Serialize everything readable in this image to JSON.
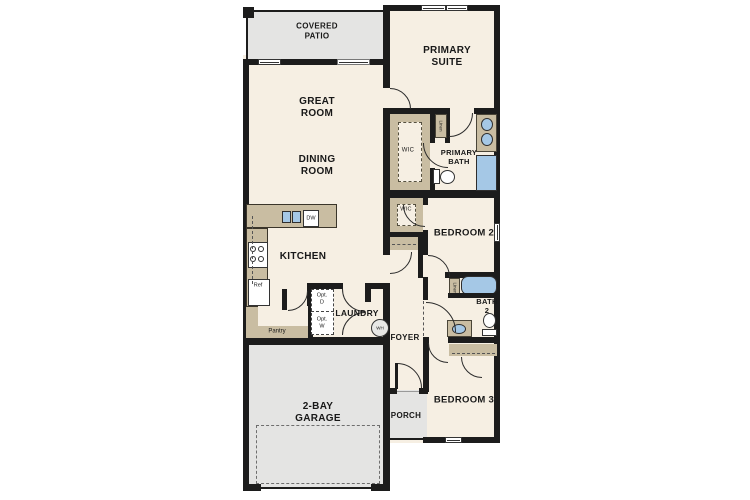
{
  "rooms": {
    "covered_patio": "COVERED\nPATIO",
    "primary_suite": "PRIMARY\nSUITE",
    "great_room": "GREAT\nROOM",
    "dining_room": "DINING\nROOM",
    "kitchen": "KITCHEN",
    "wic_primary": "WIC",
    "primary_bath": "PRIMARY\nBATH",
    "bedroom_2": "BEDROOM 2",
    "wic_bedroom2": "WIC",
    "bath_2": "BATH\n2",
    "laundry": "LAUNDRY",
    "foyer": "FOYER",
    "porch": "PORCH",
    "bedroom_3": "BEDROOM 3",
    "garage": "2-BAY\nGARAGE"
  },
  "fixtures": {
    "linen_primary": "Linen",
    "linen_bath2": "Linen",
    "refrigerator": "Ref",
    "dishwasher": "DW",
    "pantry": "Pantry",
    "optional_dryer": "Opt.\nD",
    "optional_washer": "Opt.\nW",
    "water_heater": "WH"
  },
  "colors": {
    "wall": "#1c1c1c",
    "floor": "#f6efe3",
    "outdoor": "#e4e4e3",
    "casework": "#c9bda2",
    "plumbing": "#a5c8e6"
  }
}
